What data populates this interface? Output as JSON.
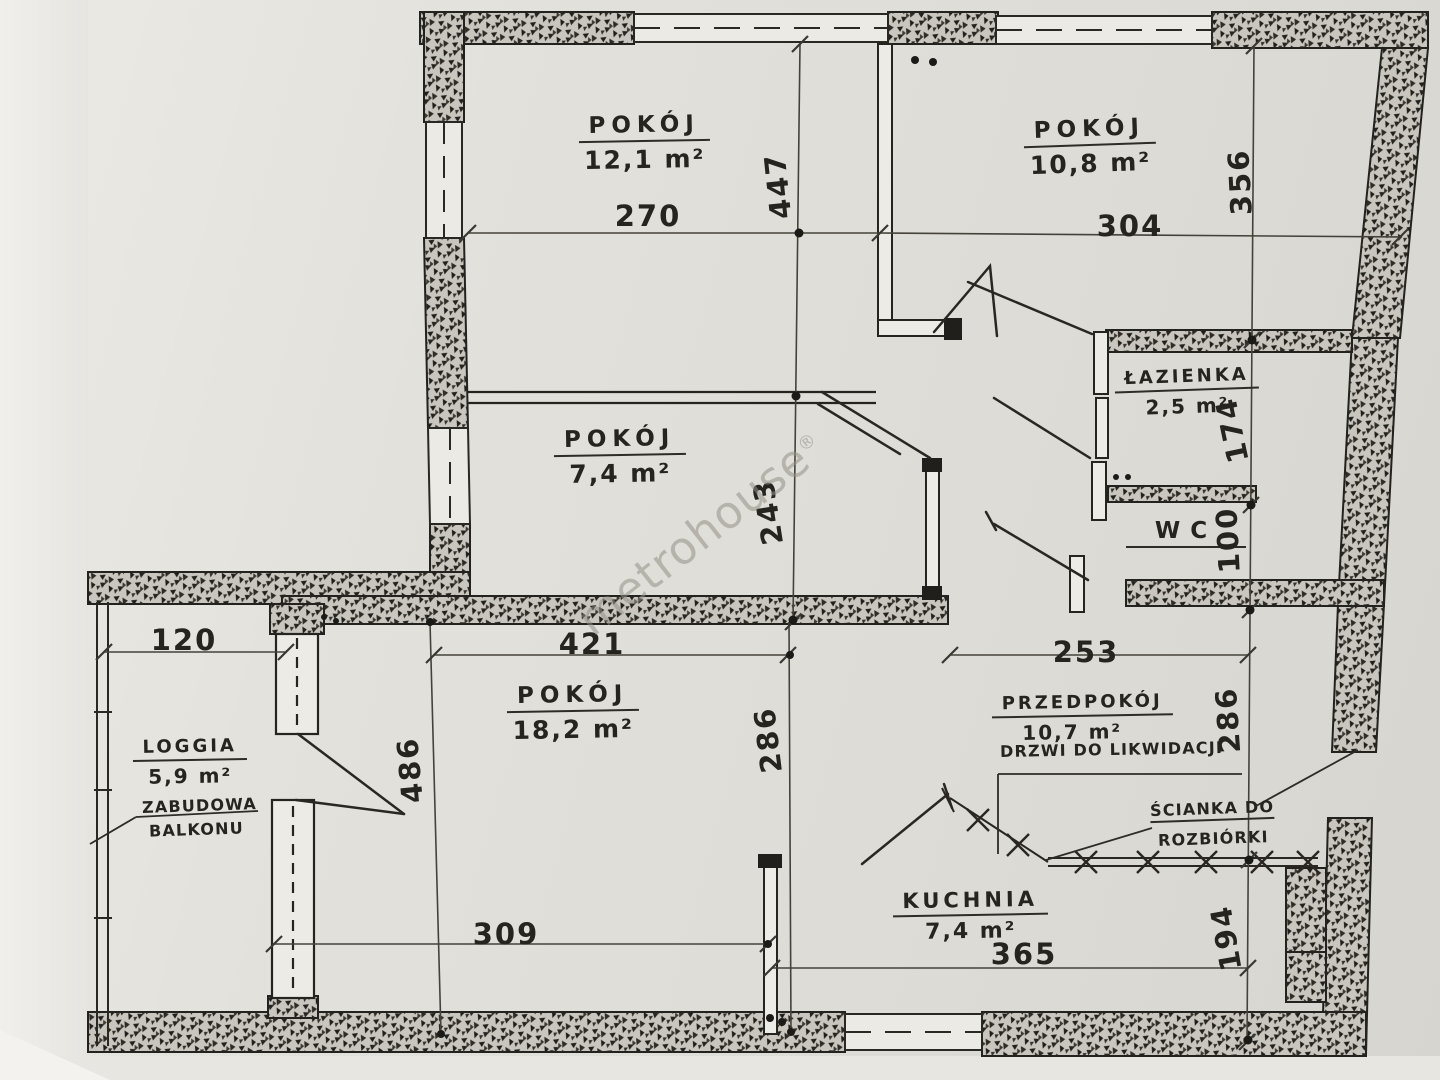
{
  "watermark": {
    "text": "metrohouse",
    "reg": "®"
  },
  "rooms": {
    "r121": {
      "name": "POKÓJ",
      "area": "12,1 m²"
    },
    "r108": {
      "name": "POKÓJ",
      "area": "10,8 m²"
    },
    "r74": {
      "name": "POKÓJ",
      "area": "7,4 m²"
    },
    "bath": {
      "name": "ŁAZIENKA",
      "area": "2,5 m²"
    },
    "wc": {
      "name": "WC"
    },
    "r182": {
      "name": "POKÓJ",
      "area": "18,2 m²"
    },
    "hall": {
      "name": "PRZEDPOKÓJ",
      "area": "10,7 m²"
    },
    "kitchen": {
      "name": "KUCHNIA",
      "area": "7,4 m²"
    },
    "loggia": {
      "name": "LOGGIA",
      "area": "5,9 m²"
    }
  },
  "notes": {
    "doors_removal": "DRZWI DO LIKWIDACJI",
    "wall_demolition_line1": "ŚCIANKA DO",
    "wall_demolition_line2": "ROZBIÓRKI",
    "balcony_line1": "ZABUDOWA",
    "balcony_line2": "BALKONU"
  },
  "dims": {
    "room121_width": "270",
    "room121_height": "447",
    "room108_width": "304",
    "room108_height": "356",
    "bath_height": "174",
    "wc_height": "100",
    "room74_height": "243",
    "loggia_width": "120",
    "room182_width": "421",
    "hall_width": "253",
    "room182_left_height": "486",
    "room182_right_height": "286",
    "hall_height": "286",
    "kitchen_height": "194",
    "room182_bottom_width": "309",
    "kitchen_width": "365"
  }
}
